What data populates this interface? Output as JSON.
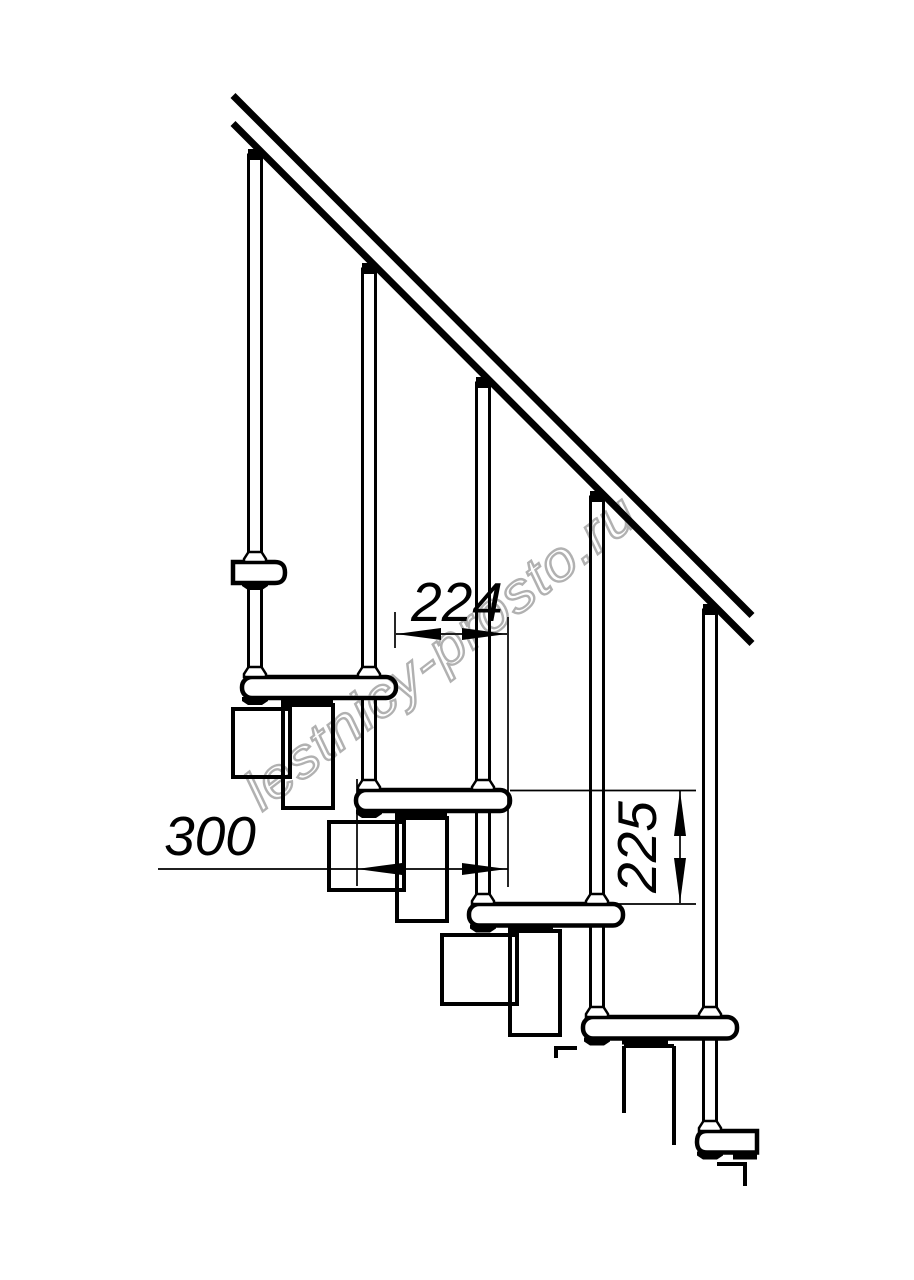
{
  "drawing": {
    "kind": "staircase-side-elevation",
    "palette": {
      "ink": "#000000",
      "background": "#ffffff",
      "watermark_color": "#a3a3a3"
    },
    "watermark": {
      "text": "lestnicy-prosto.ru"
    },
    "dimensions": [
      {
        "id": "going",
        "value": "224",
        "orientation": "horizontal"
      },
      {
        "id": "tread-depth",
        "value": "300",
        "orientation": "horizontal"
      },
      {
        "id": "rise",
        "value": "225",
        "orientation": "vertical"
      }
    ],
    "components": {
      "handrail": 1,
      "baluster_rods": 5,
      "treads": 6,
      "stringer_modules": 4
    }
  }
}
